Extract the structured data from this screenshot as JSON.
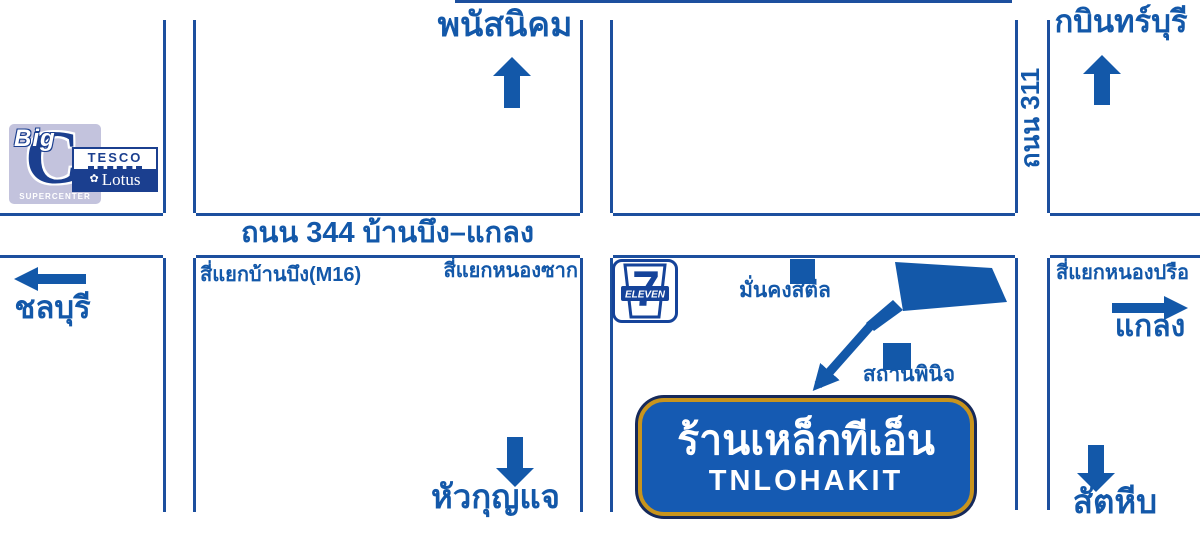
{
  "colors": {
    "road_line": "#1c4f9e",
    "text_blue": "#1358a9",
    "navy": "#1b3f8f",
    "box_fill": "#155ab2",
    "box_border_gold": "#c8941d",
    "box_outline": "#15295b",
    "bigc_background": "#c3c3dd",
    "white": "#ffffff"
  },
  "labels": {
    "north_top": "พนัสนิคม",
    "north_right": "กบินทร์บุรี",
    "west": "ชลบุรี",
    "east": "แกลง",
    "south_center": "หัวกุญแจ",
    "south_right": "สัตหีบ",
    "road_344": "ถนน 344 บ้านบึง–แกลง",
    "road_311": "ถนน 311",
    "intersection_banbueng": "สี่แยกบ้านบึง(M16)",
    "intersection_nongsak": "สี่แยกหนองซาก",
    "intersection_nongprue": "สี่แยกหนองปรือ",
    "landmark_mankong_steel": "มั่นคงสตีล",
    "landmark_sathanpinit": "สถานพินิจ"
  },
  "destination_box": {
    "thai_name": "ร้านเหล็กทีเอ็น",
    "english_name": "TNLOHAKIT"
  },
  "logos": {
    "big_c": {
      "big": "Big",
      "c": "C",
      "subtext": "SUPERCENTER"
    },
    "tesco_lotus": {
      "top": "TESCO",
      "bottom": "Lotus",
      "flower_icon": "✿"
    },
    "seven_eleven": {
      "seven": "7",
      "eleven": "ELEVEN"
    }
  }
}
